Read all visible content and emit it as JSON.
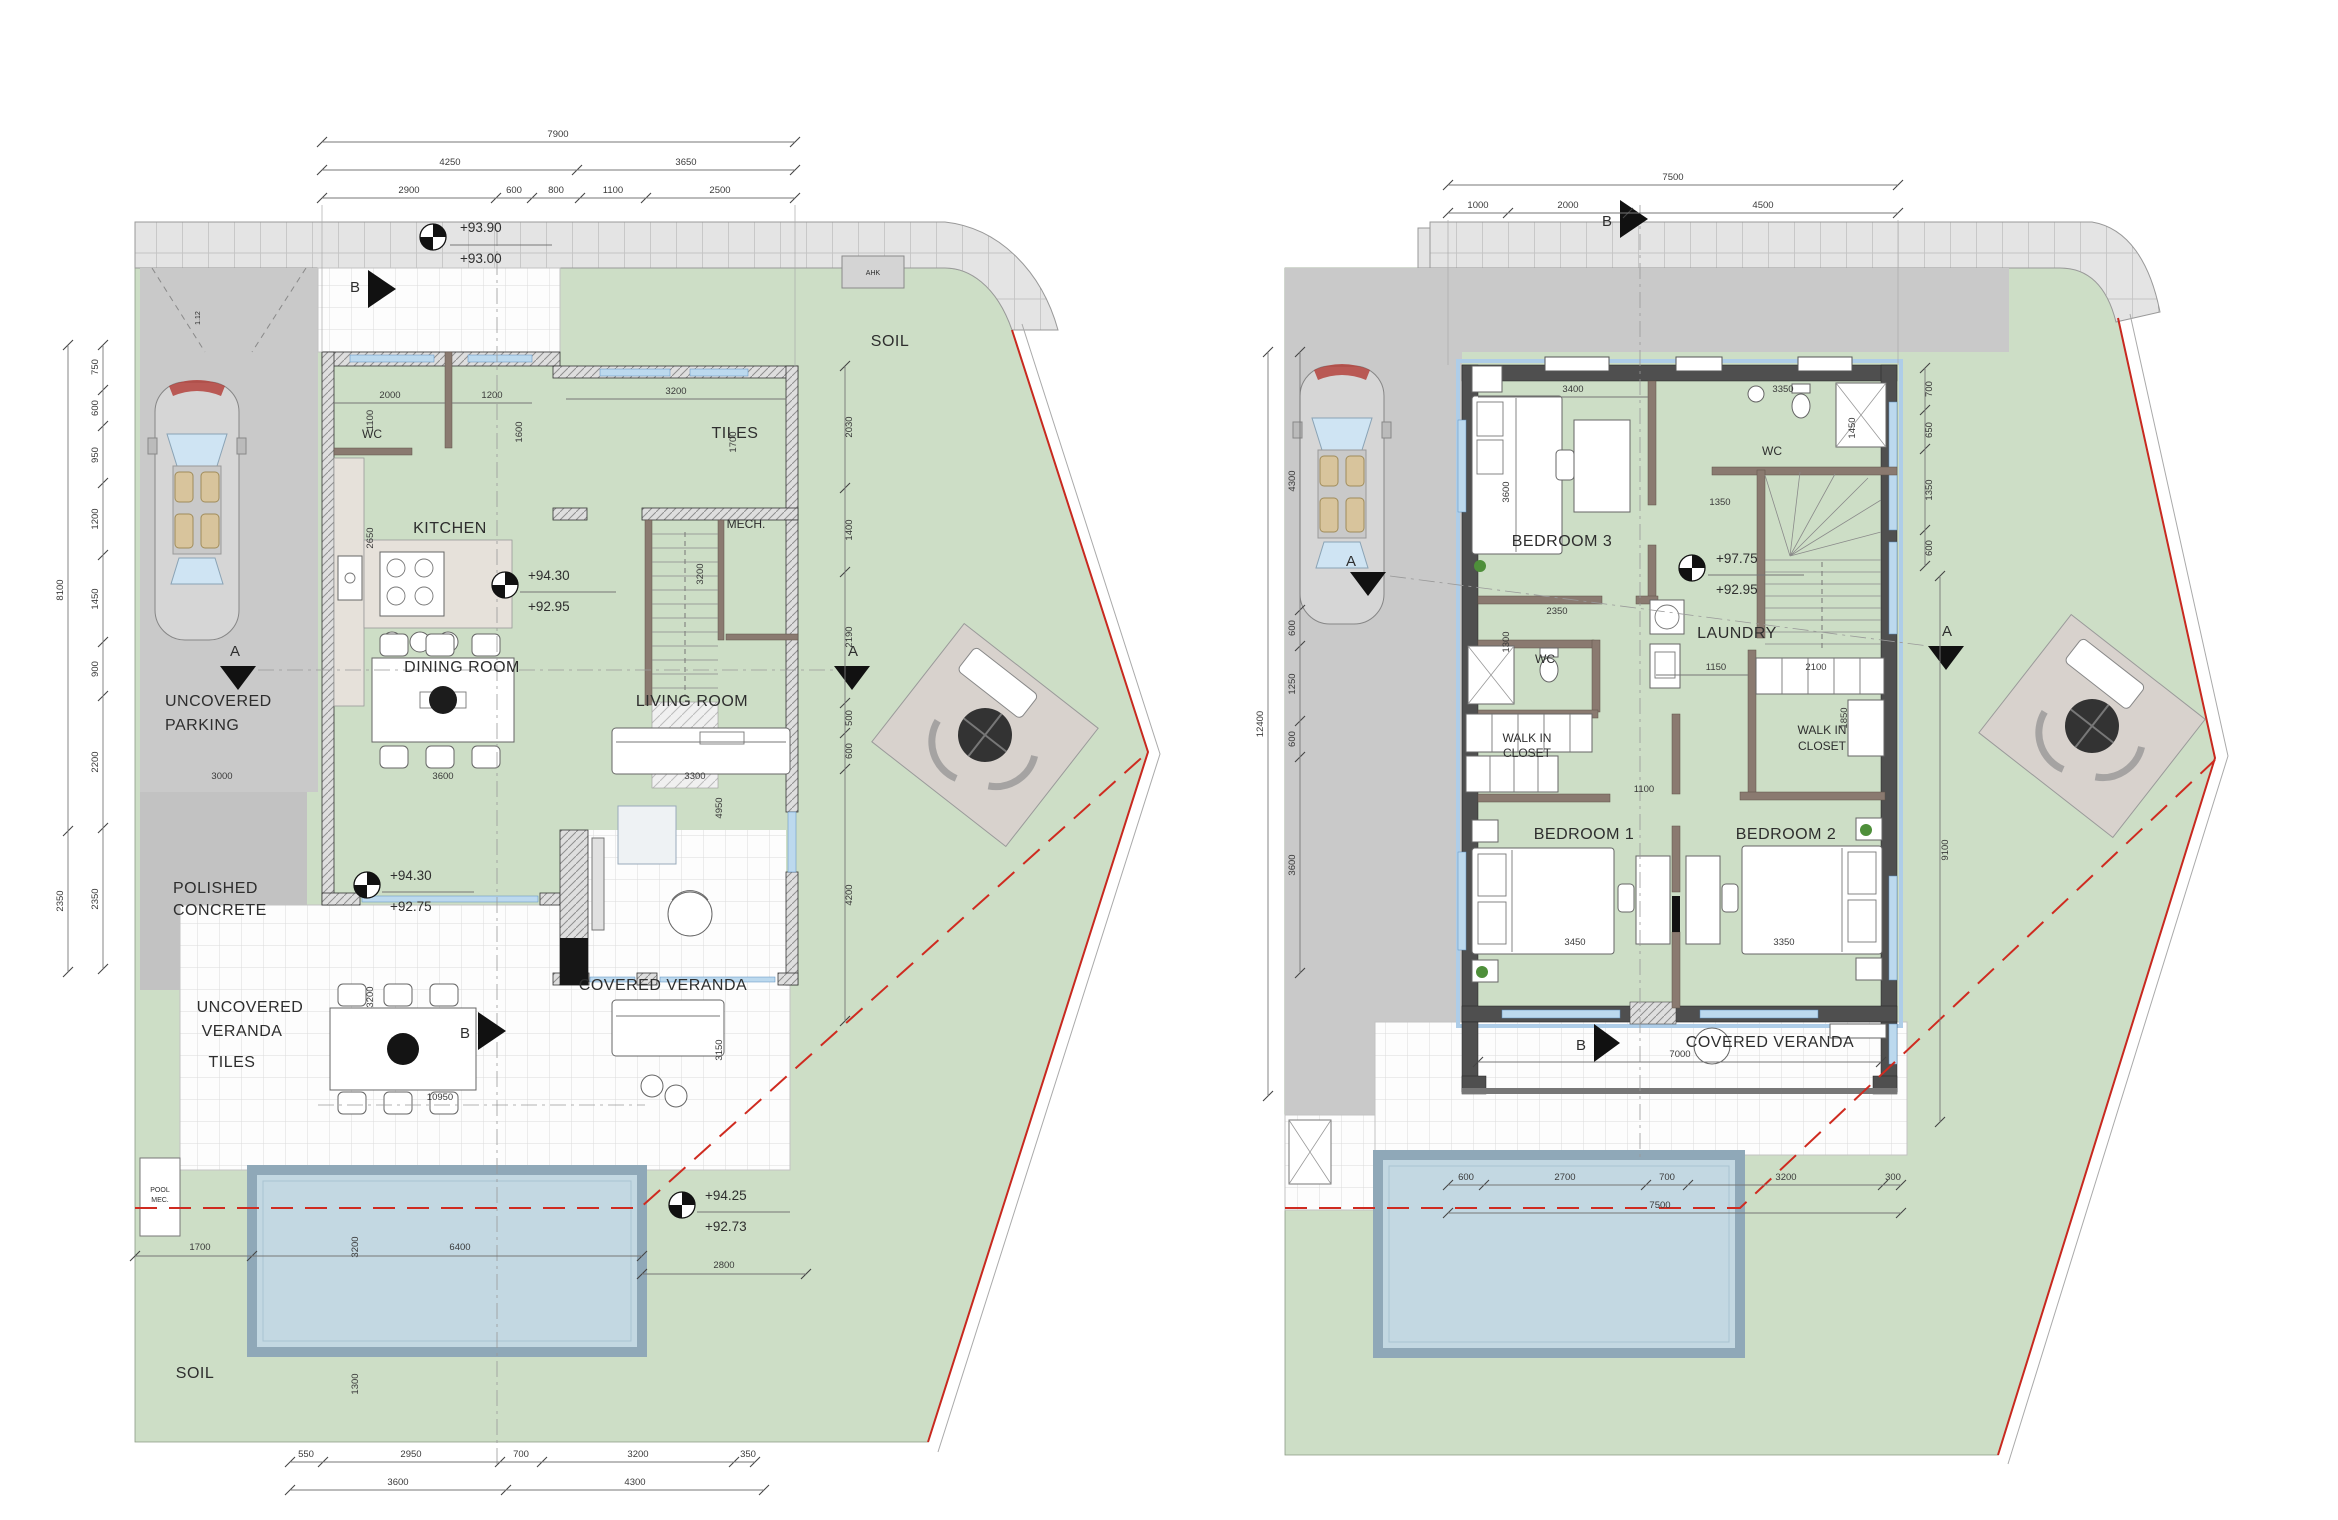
{
  "doc": {
    "type": "architectural floor plans",
    "sheets": [
      "ground floor plan",
      "first floor plan"
    ]
  },
  "colors": {
    "site_green": "#cddec6",
    "pool_water": "#c3d8e2",
    "pool_edge": "#8fa8b8",
    "driveway_grey": "#c9c9c9",
    "boundary_red": "#c8291f",
    "wall_dark": "#4f4f4f"
  },
  "left": {
    "rooms": {
      "wc": "WC",
      "kitchen": "KITCHEN",
      "dining": "DINING ROOM",
      "living": "LIVING ROOM",
      "mech": "MECH.",
      "tiles_upper": "TILES",
      "tiles_lower": "TILES",
      "covered_veranda": "COVERED VERANDA",
      "uncovered_veranda_1": "UNCOVERED",
      "uncovered_veranda_2": "VERANDA",
      "parking_1": "UNCOVERED",
      "parking_2": "PARKING",
      "polished_1": "POLISHED",
      "polished_2": "CONCRETE",
      "soil_top": "SOIL",
      "soil_bottom": "SOIL",
      "pool_mec_1": "POOL",
      "pool_mec_2": "MEC.",
      "ahk": "AHK",
      "slope": "1.12"
    },
    "levels": {
      "street_a": "+93.90",
      "street_b": "+93.00",
      "main_a": "+94.30",
      "main_b": "+92.95",
      "veranda_a": "+94.30",
      "veranda_b": "+92.75",
      "pool_a": "+94.25",
      "pool_b": "+92.73"
    },
    "sections": {
      "a": "A",
      "b": "B"
    },
    "dims_total_top": "7900",
    "dims_top_mid": [
      "4250",
      "3650"
    ],
    "dims_top": [
      "2900",
      "600",
      "800",
      "1100",
      "2500"
    ],
    "dims_left_total": [
      "8100",
      "2350"
    ],
    "dims_left": [
      "750",
      "600",
      "950",
      "1200",
      "1450",
      "900",
      "2200",
      "2350"
    ],
    "dims_bottom": [
      "550",
      "2950",
      "700",
      "3200",
      "350"
    ],
    "dims_bottom2": [
      "3600",
      "4300"
    ],
    "dims_right": [
      "2030",
      "1400",
      "2190",
      "500",
      "600",
      "4200"
    ],
    "dims_inner": {
      "wc_w": "2000",
      "door": "1200",
      "tiles_w": "3200",
      "tiles_h": "1700",
      "kitchen_d": "1600",
      "wc_d": "1100",
      "kitchen_h": "2650",
      "stair_h": "3200",
      "dining_w": "3600",
      "living_w": "3300",
      "living_h": "4950",
      "veranda_h": "3150",
      "parking_w": "3000",
      "veranda_v": "3200",
      "bottom_chain": "10950",
      "pool_off": "1700",
      "pool_w": "6400",
      "pool_h": "3200",
      "pool_s": "1300",
      "soil_w": "2800"
    }
  },
  "right": {
    "rooms": {
      "bedroom3": "BEDROOM 3",
      "wc1": "WC",
      "laundry": "LAUNDRY",
      "wc2": "WC",
      "wic_a": "WALK IN",
      "wic_b": "CLOSET",
      "bedroom1": "BEDROOM 1",
      "bedroom2": "BEDROOM 2",
      "covered_veranda": "COVERED VERANDA"
    },
    "levels": {
      "floor_a": "+97.75",
      "floor_b": "+92.95"
    },
    "sections": {
      "a": "A",
      "b": "B"
    },
    "dims_total_top": "7500",
    "dims_top": [
      "1000",
      "2000",
      "4500"
    ],
    "dims_left_total": "12400",
    "dims_left": [
      "4300",
      "600",
      "1250",
      "600",
      "3600"
    ],
    "dims_right": [
      "700",
      "650",
      "1350",
      "600"
    ],
    "dims_right_total": "9100",
    "dims_bottom": [
      "600",
      "2700",
      "700",
      "3200",
      "300"
    ],
    "dims_bottom_total": "7500",
    "dims_inner": {
      "veranda_w": "7000",
      "bed3_w": "3400",
      "bed3_h": "3600",
      "wc1_w": "3350",
      "wc1_h": "1450",
      "hall": "1350",
      "wc2_w": "2350",
      "wc2_h": "1300",
      "hall2": "1150",
      "wic2_w": "2100",
      "wic2_h": "1850",
      "bed1_door": "1100",
      "bed1_w": "3450",
      "bed2_w": "3350"
    }
  }
}
